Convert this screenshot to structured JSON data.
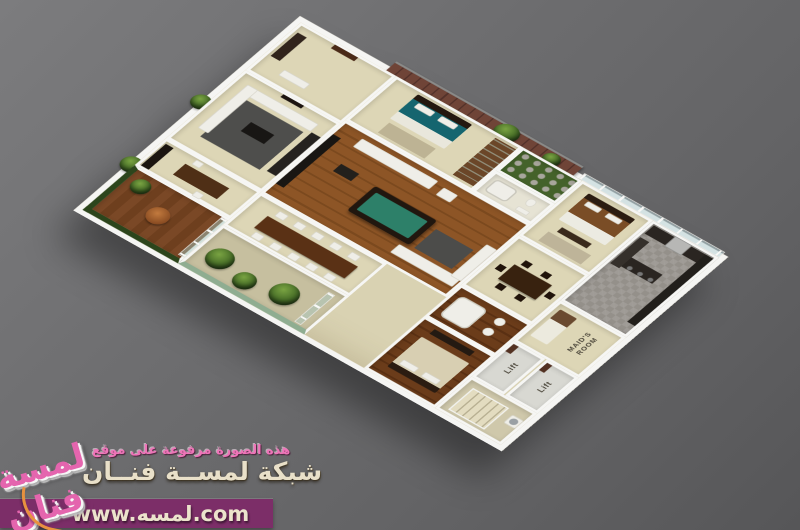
{
  "plan": {
    "labels": {
      "maids_room": "MAID'S ROOM",
      "lift_left": "Lift",
      "lift_right": "Lift"
    },
    "palette": {
      "background_gray_top": "#7c7c7e",
      "background_gray_bottom": "#565658",
      "wall_white": "#f5f5f3",
      "floor_beige": "#d9d2b2",
      "floor_wood": "#8d5526",
      "floor_tile_gray": "#94908a",
      "pool_table_felt": "#2d8069",
      "brick_wall": "#6f4437",
      "kitchen_cabinet_dark": "#2a2521",
      "plant_green": "#456b26"
    }
  },
  "watermark": {
    "line1": "هذه الصورة مرفوعة على موقع",
    "line2": "شبكة لمســة فنــان",
    "url": "www.لمسه.com",
    "logo_text": "لمسة فنان",
    "bar_color": "#7c2e68",
    "line1_color": "#ee74b8",
    "cream_text_color": "#e9e0c9"
  }
}
